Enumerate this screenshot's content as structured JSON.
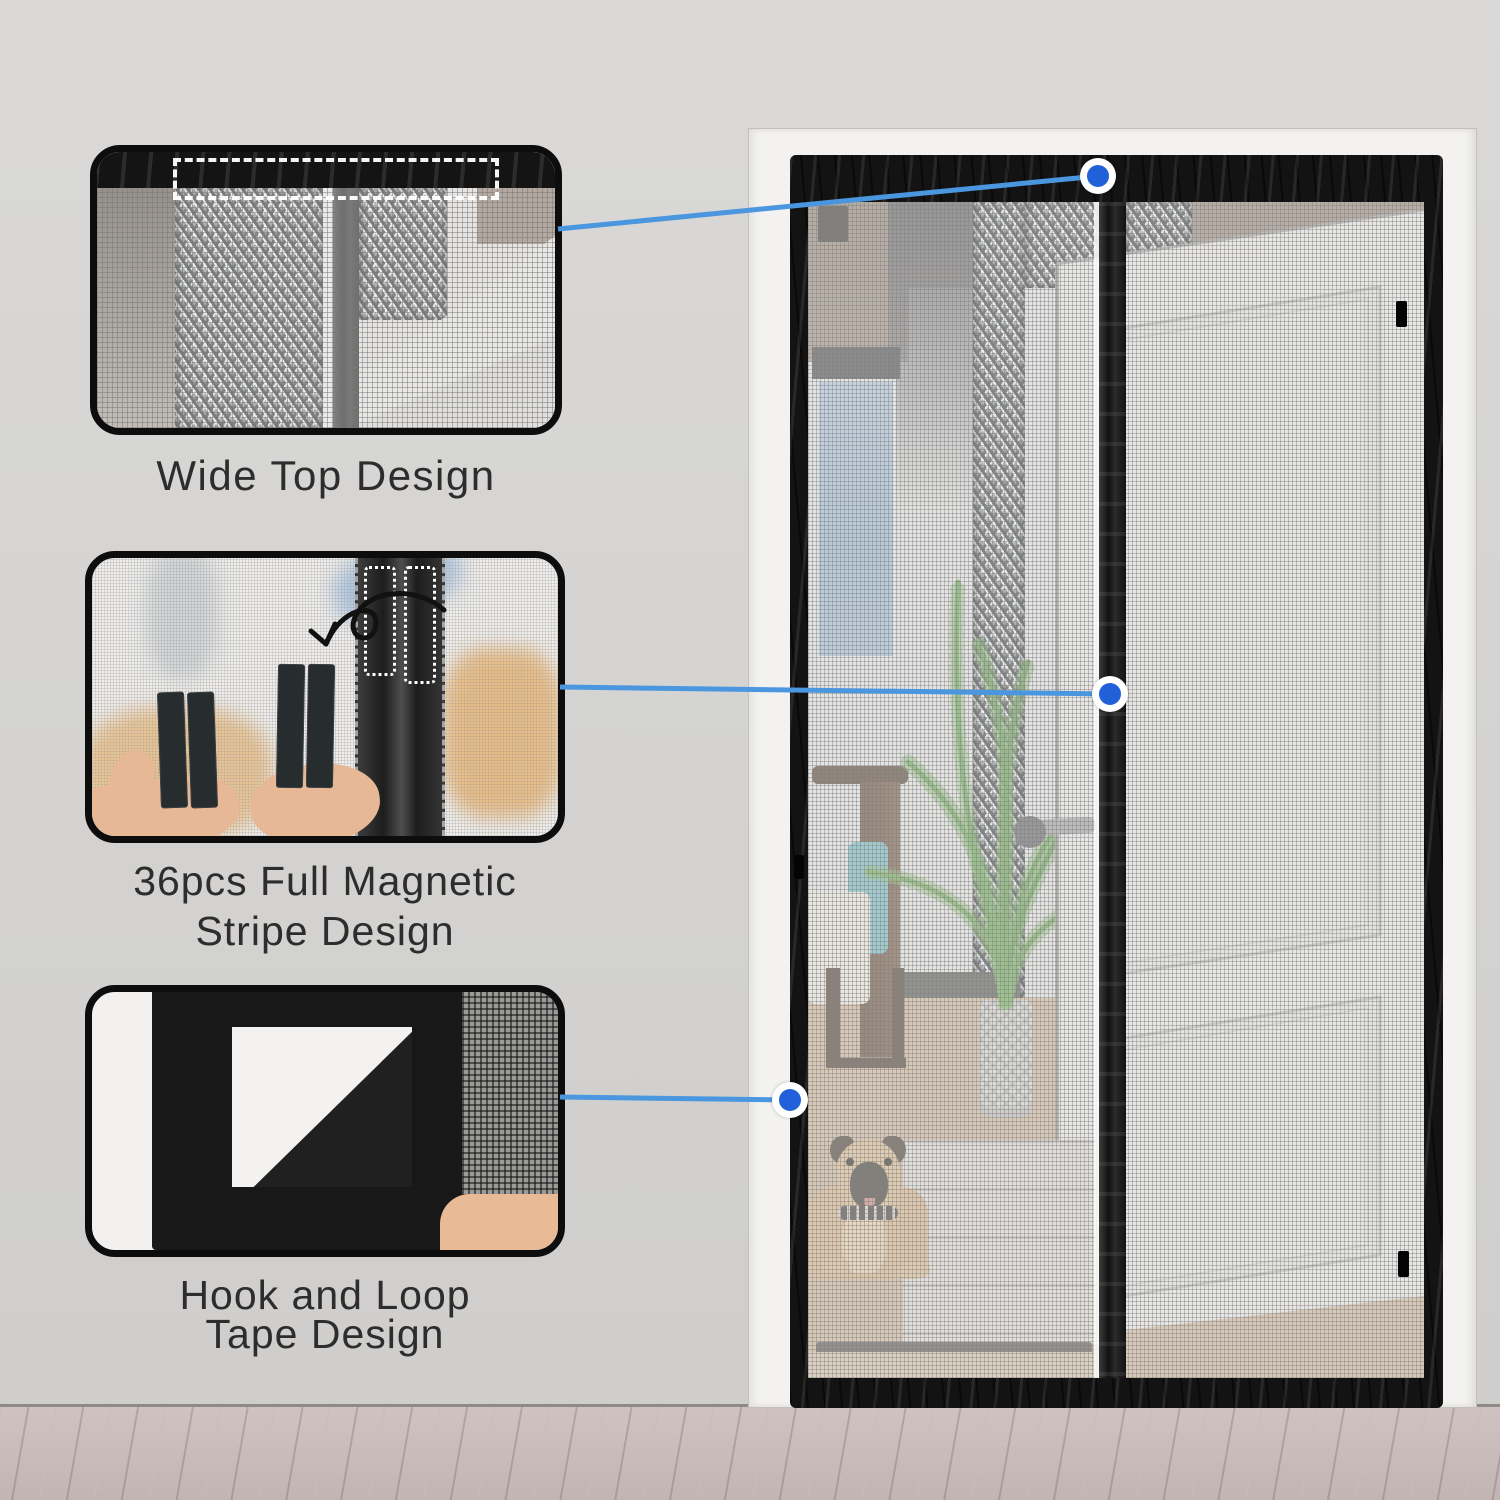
{
  "callouts": [
    {
      "id": "wide-top",
      "lines": [
        "Wide Top Design"
      ]
    },
    {
      "id": "magnetic-stripe",
      "lines": [
        "36pcs Full Magnetic",
        "Stripe Design"
      ]
    },
    {
      "id": "hook-loop",
      "lines": [
        "Hook and Loop",
        "Tape Design"
      ]
    }
  ],
  "markers": [
    {
      "target": "wide-top"
    },
    {
      "target": "magnetic-stripe"
    },
    {
      "target": "hook-loop"
    }
  ],
  "theme": {
    "wall_color": "#d5d4d2",
    "floor_color": "#c8bcbb",
    "casing_color": "#f3f2f0",
    "frame_color": "#131313",
    "mesh_color": "#e4e3e1",
    "accent_color": "#4b97df",
    "marker_color": "#2160d8",
    "marker_ring_color": "#ffffff",
    "label_color": "#2d2d2d"
  }
}
